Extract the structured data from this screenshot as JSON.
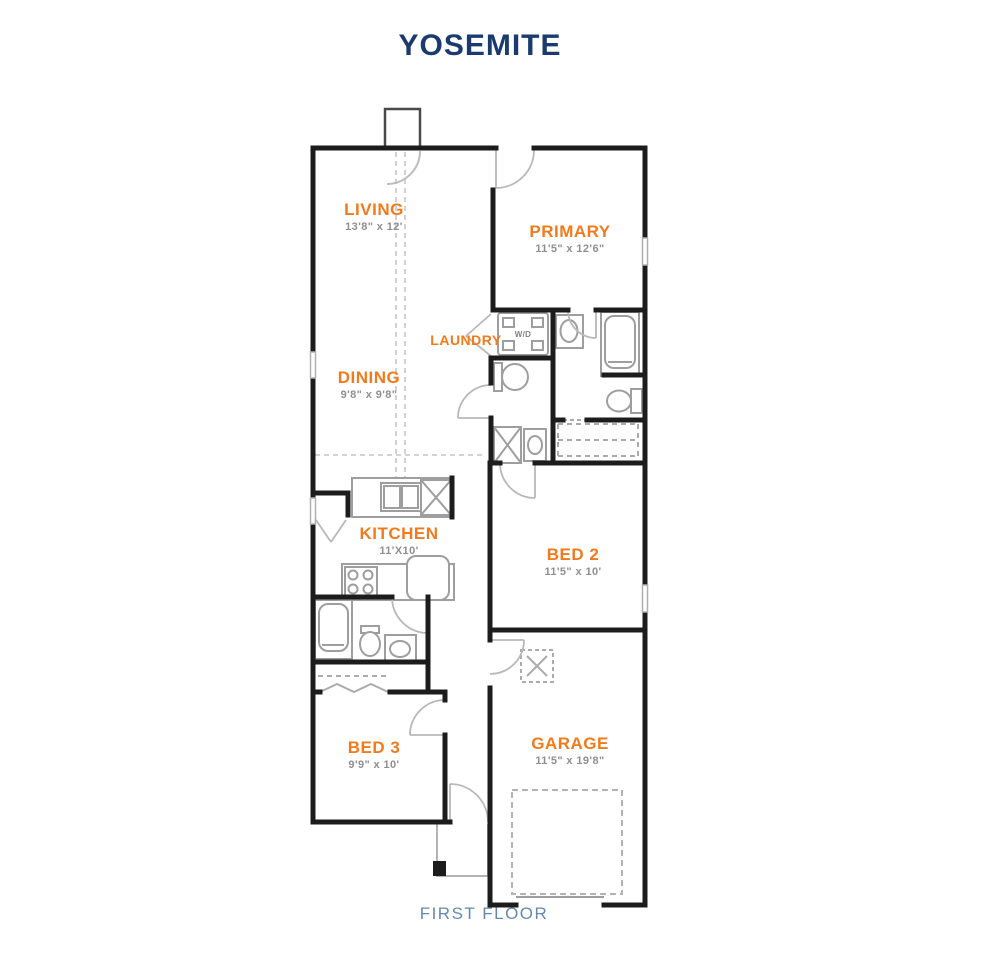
{
  "title": "YOSEMITE",
  "floor_label": "FIRST FLOOR",
  "colors": {
    "title_navy": "#1b3a6d",
    "floor_label_blue": "#6688ad",
    "room_label_orange": "#ef7b1e",
    "dimension_gray": "#8f8f8f",
    "wall_black": "#1c1c1c",
    "fixture_gray": "#9e9e9e"
  },
  "rooms": {
    "living": {
      "name": "LIVING",
      "dims": "13'8\" x 12'"
    },
    "primary": {
      "name": "PRIMARY",
      "dims": "11'5\" x 12'6\""
    },
    "laundry": {
      "name": "LAUNDRY"
    },
    "dining": {
      "name": "DINING",
      "dims": "9'8\" x 9'8\""
    },
    "kitchen": {
      "name": "KITCHEN",
      "dims": "11'X10'"
    },
    "bed2": {
      "name": "BED 2",
      "dims": "11'5\" x 10'"
    },
    "bed3": {
      "name": "BED 3",
      "dims": "9'9\" x 10'"
    },
    "garage": {
      "name": "GARAGE",
      "dims": "11'5\" x 19'8\""
    }
  },
  "fixtures": {
    "washer_dryer": "W/D"
  }
}
